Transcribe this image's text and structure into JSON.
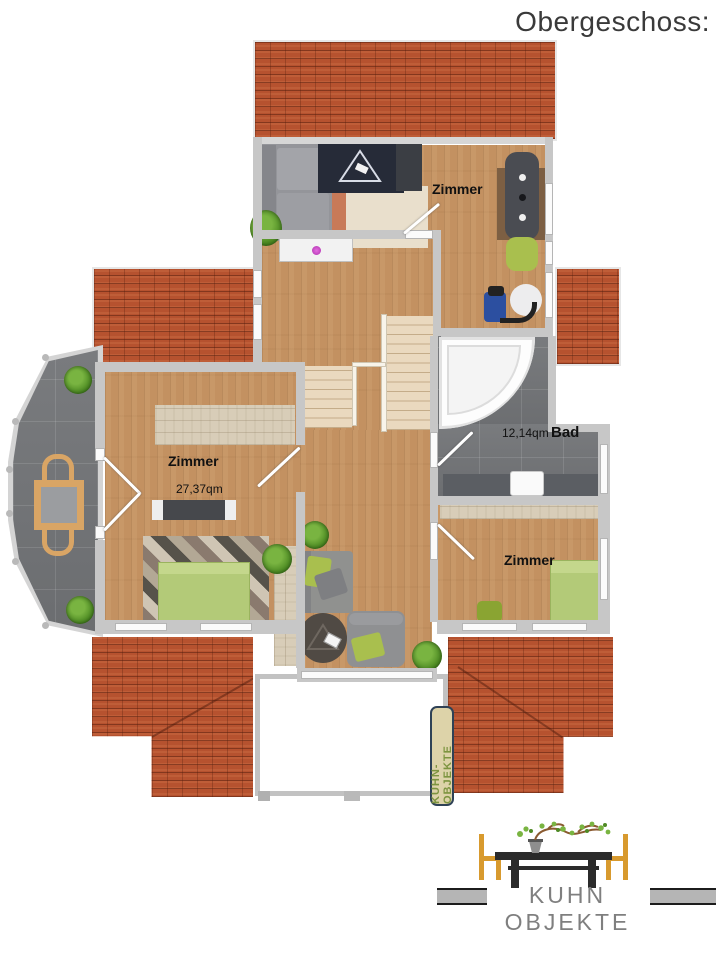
{
  "title": "Obergeschoss:",
  "rooms": {
    "top": {
      "label": "Zimmer"
    },
    "left": {
      "label": "Zimmer",
      "area": "27,37qm"
    },
    "bath": {
      "label": "Bad",
      "area": "12,14qm"
    },
    "right": {
      "label": "Zimmer"
    }
  },
  "tag": {
    "text": "KUHN-OBJEKTE"
  },
  "logo": {
    "name": "KUHN OBJEKTE"
  },
  "colors": {
    "roof": "#b6522f",
    "wood": "#c39161",
    "tile": "#717376",
    "wall": "#c7c7c7",
    "stair": "#ead9bf",
    "accent_green": "#a9bf4e",
    "bed_green": "#b3ca78",
    "logo_chair": "#d89a2e",
    "logo_wood": "#2b2b2b",
    "logo_text": "#7f7f7f",
    "tag_text": "#7d9440",
    "tag_bg": "#ddd3a9",
    "label_text": "#111111",
    "title_text": "#3a3a3a"
  }
}
